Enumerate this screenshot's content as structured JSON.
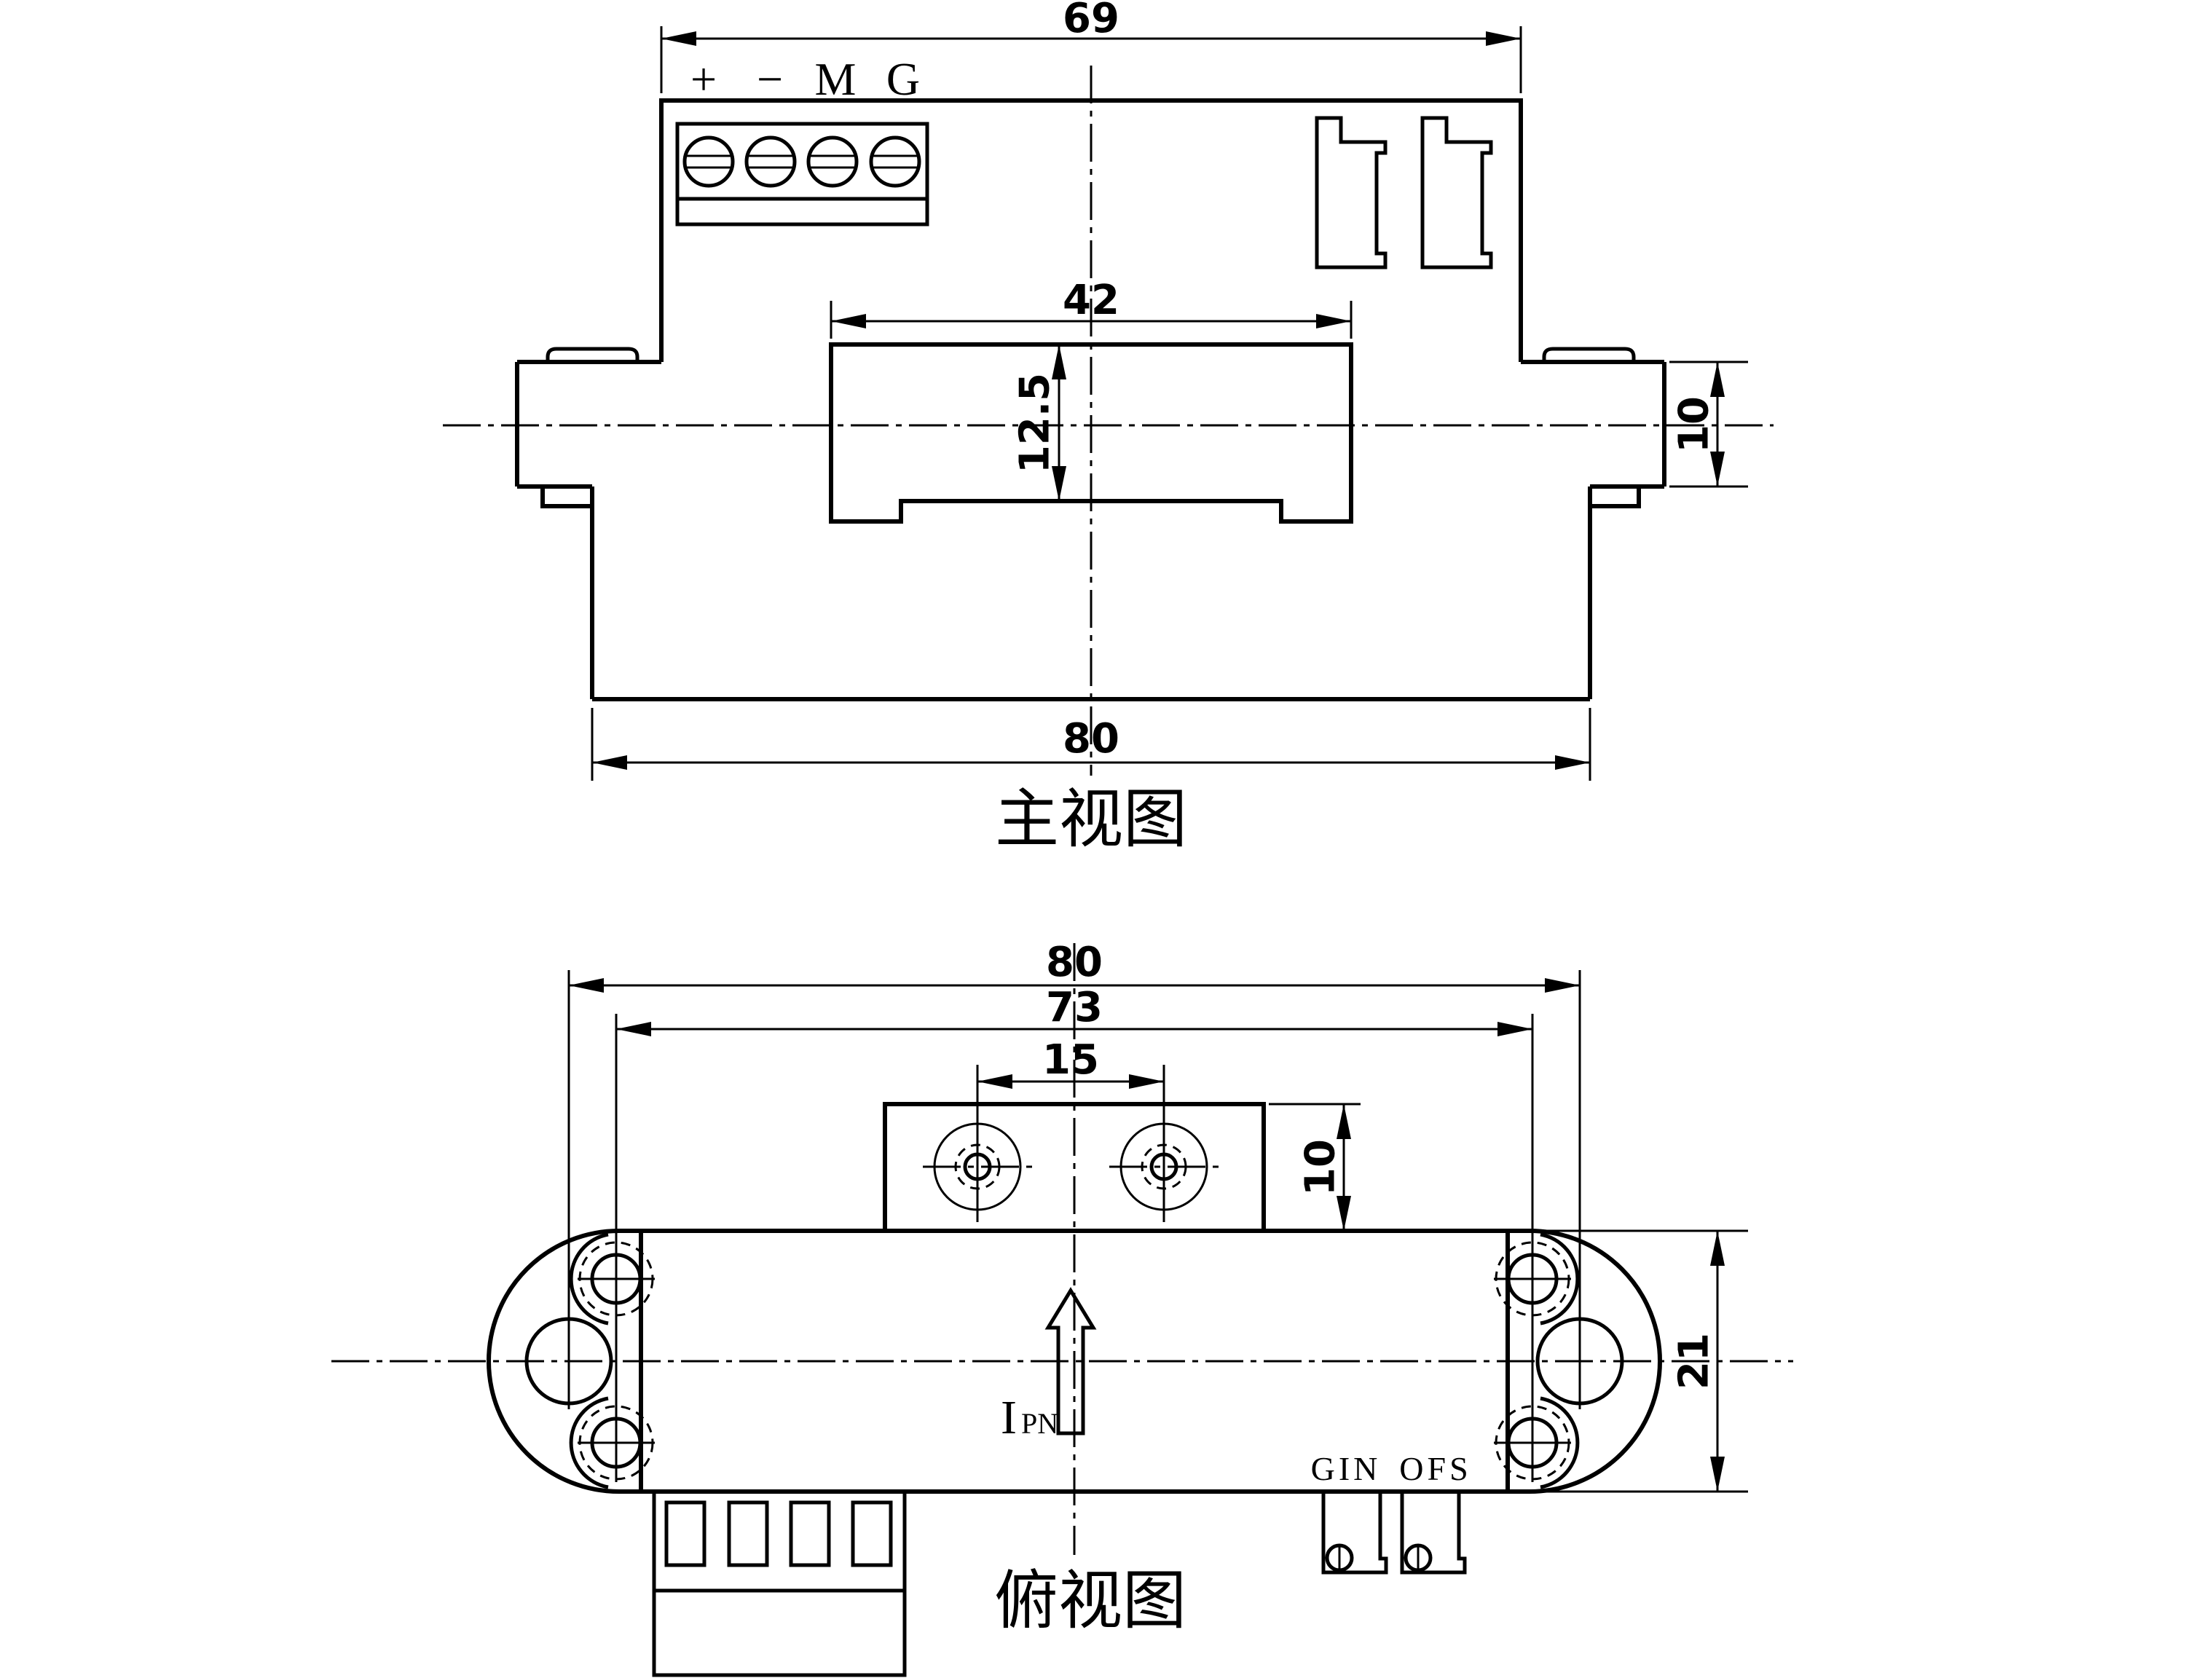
{
  "front_view": {
    "title": "主视图",
    "terminal_labels": [
      "+",
      "−",
      "M",
      "G"
    ],
    "dims": {
      "top_width": "69",
      "boss_width": "42",
      "boss_height": "12.5",
      "flange_height": "10",
      "base_width": "80"
    }
  },
  "top_view": {
    "title": "俯视图",
    "dims": {
      "overall_width": "80",
      "mount_hole_spacing": "73",
      "bracket_hole_spacing": "15",
      "bracket_depth": "10",
      "body_depth": "21"
    },
    "labels": {
      "current_symbol": "I",
      "current_subscript": "PN",
      "pot_left": "GIN",
      "pot_right": "OFS"
    }
  }
}
